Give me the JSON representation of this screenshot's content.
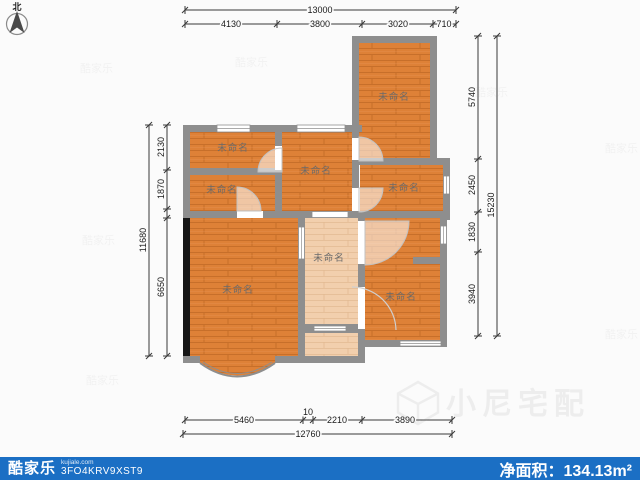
{
  "compass": {
    "label": "北"
  },
  "rooms": [
    {
      "id": "room-top-left",
      "label": "未命名"
    },
    {
      "id": "room-left-small",
      "label": "未命名"
    },
    {
      "id": "room-living",
      "label": "未命名"
    },
    {
      "id": "room-top-right",
      "label": "未命名"
    },
    {
      "id": "room-mid-right",
      "label": "未命名"
    },
    {
      "id": "room-hall",
      "label": "未命名"
    },
    {
      "id": "room-bottom-left",
      "label": "未命名"
    },
    {
      "id": "room-bottom-right",
      "label": "未命名"
    }
  ],
  "dims": {
    "top": {
      "total": "13000",
      "segments": [
        "4130",
        "3800",
        "3020",
        "710"
      ]
    },
    "bottom": {
      "total": "12760",
      "segments": [
        "5460",
        "10",
        "2210",
        "3890"
      ]
    },
    "left": {
      "total": "11680",
      "segments": [
        "2130",
        "1870",
        "6650"
      ]
    },
    "right": {
      "total": "15230",
      "segments": [
        "5740",
        "2450",
        "1830",
        "3940"
      ]
    }
  },
  "footer": {
    "logo": "酷家乐",
    "domain": "kujiale.com",
    "plan_code": "3FO4KRV9XST9",
    "area_label": "净面积：",
    "area_value": "134.13",
    "area_unit": "m²"
  },
  "watermark": {
    "text": "小尼宅配",
    "tile": "酷家乐"
  },
  "colors": {
    "accent_blue": "#1b6fc4",
    "floor_orange": "#de8137",
    "floor_light": "#f2cfad",
    "wall_gray": "#8e8e8e"
  }
}
